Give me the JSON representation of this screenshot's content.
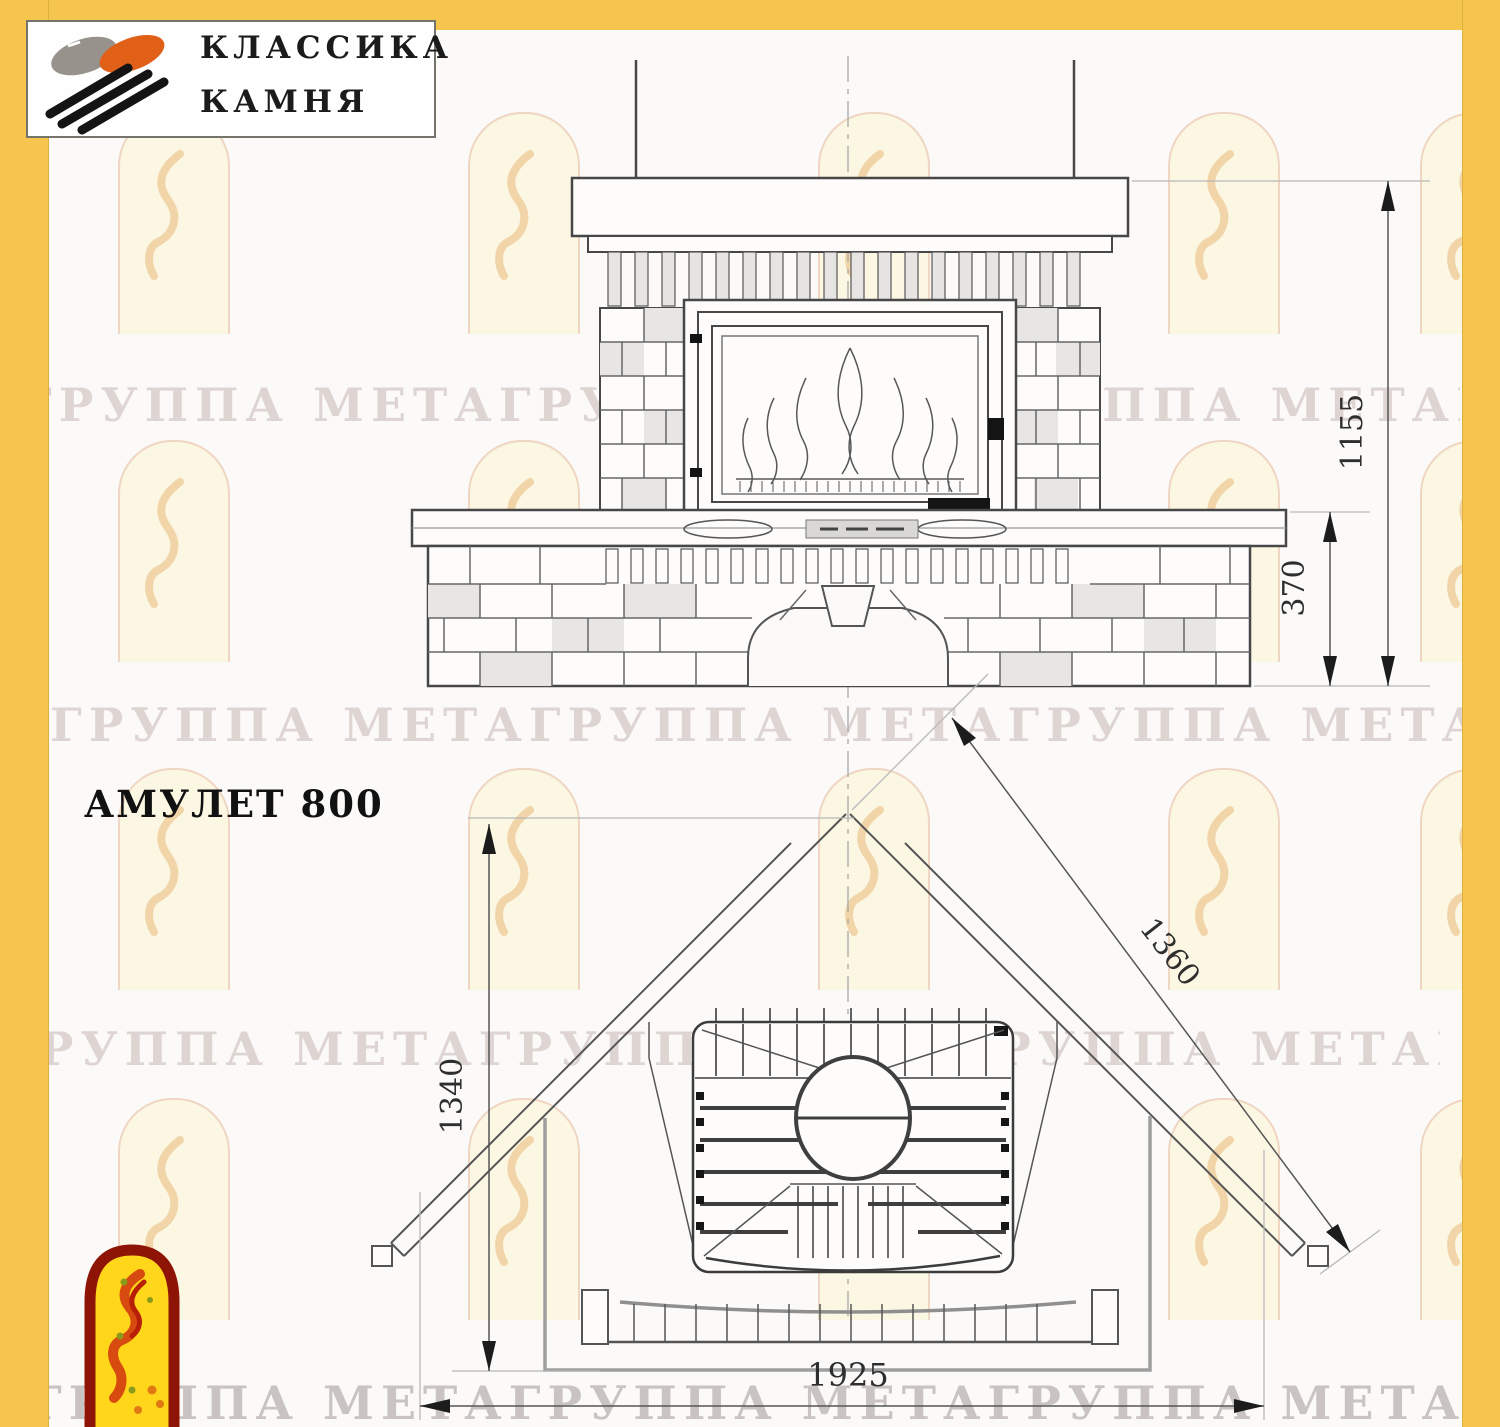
{
  "brand": {
    "line1": "КЛАССИКА",
    "line2": "КАМНЯ"
  },
  "page": {
    "title": "АМУЛЕТ 800"
  },
  "watermark": {
    "text": "ГРУППА МЕТАГРУППА МЕТАГРУППА МЕТАГРУППА"
  },
  "dimensions": {
    "front_total_height": "1155",
    "front_plinth_height": "370",
    "plan_front_width": "1360",
    "plan_depth": "1340",
    "plan_overall_width": "1925"
  },
  "colors": {
    "frame_yellow": "#f5c54d",
    "emblem_red": "#8e1506",
    "emblem_yellow": "#ffd61a",
    "logo_orange": "#e06018",
    "logo_gray": "#98928c",
    "line_dark": "#474747"
  }
}
